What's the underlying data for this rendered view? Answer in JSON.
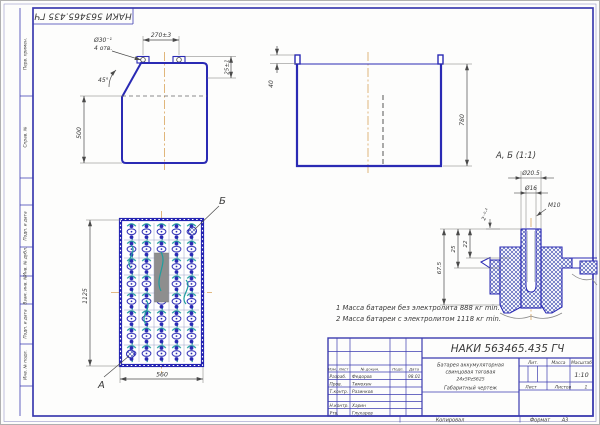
{
  "colors": {
    "frame": "#3c3cb0",
    "drawing_line": "#2a2ab4",
    "connector_teal": "#1f9e9e",
    "centerline_orange": "#d9a45b",
    "dimension": "#4a4a4a",
    "label_gray": "#8e8e8e"
  },
  "stamp_top": "НАКИ 563465.435 ГЧ",
  "margin_labels": {
    "perv": "Перв. примен.",
    "sprav": "Справ. №",
    "podp1": "Подп. и дата",
    "inv_dubl": "Инв. № дубл.",
    "vzam": "Взам. инв. №",
    "podp2": "Подп. и дата",
    "inv_podl": "Инв. № подл."
  },
  "front_view": {
    "dim_holes_pitch": "270±3",
    "hole_dia": "Ø30⁻¹",
    "hole_qty": "4 отв.",
    "chamfer": "45°",
    "dim_terminal": "25±1",
    "dim_height": "500"
  },
  "side_view": {
    "dim_lip": "40",
    "dim_height": "780"
  },
  "top_view": {
    "dim_length": "1125",
    "dim_width": "560",
    "label_a": "А",
    "label_b": "Б"
  },
  "detail_view": {
    "title": "А, Б (1:1)",
    "dia_outer": "Ø20.5",
    "dia_inner": "Ø16",
    "thread": "M10",
    "dim_depth": "2⁻⁰·²",
    "dim_h1": "67.5",
    "dim_h2": "25",
    "dim_h3": "22"
  },
  "notes": {
    "line1": "1 Масса батареи без электролита 888 кг min.",
    "line2": "2 Масса батареи с электролитом 1118 кг min."
  },
  "title_block": {
    "designation": "НАКИ 563465.435 ГЧ",
    "name_line1": "Батарея аккумуляторная",
    "name_line2": "свинцовая тяговая",
    "name_line3": "24х5PzS625",
    "name_line4": "Габаритный чертеж",
    "lit_label": "Лит.",
    "mass_label": "Масса",
    "scale_label": "Масштаб",
    "scale_value": "1:10",
    "sheet_label": "Лист",
    "sheets_label": "Листов",
    "sheets_value": "1",
    "hdr": {
      "izm": "Изм.",
      "list": "Лист",
      "doc": "№ докум.",
      "podp": "Подп.",
      "data": "Дата"
    },
    "rows": [
      {
        "role": "Разраб.",
        "name": "Федоров",
        "date": "98.01"
      },
      {
        "role": "Пров.",
        "name": "Тимохин",
        "date": ""
      },
      {
        "role": "Т.контр.",
        "name": "Разинков",
        "date": ""
      },
      {
        "role": "Н.контр.",
        "name": "Харин",
        "date": ""
      },
      {
        "role": "Утв.",
        "name": "Глухарев",
        "date": ""
      }
    ]
  },
  "bottom_margin": {
    "copied": "Копировал",
    "format_label": "Формат",
    "format_value": "А3"
  }
}
